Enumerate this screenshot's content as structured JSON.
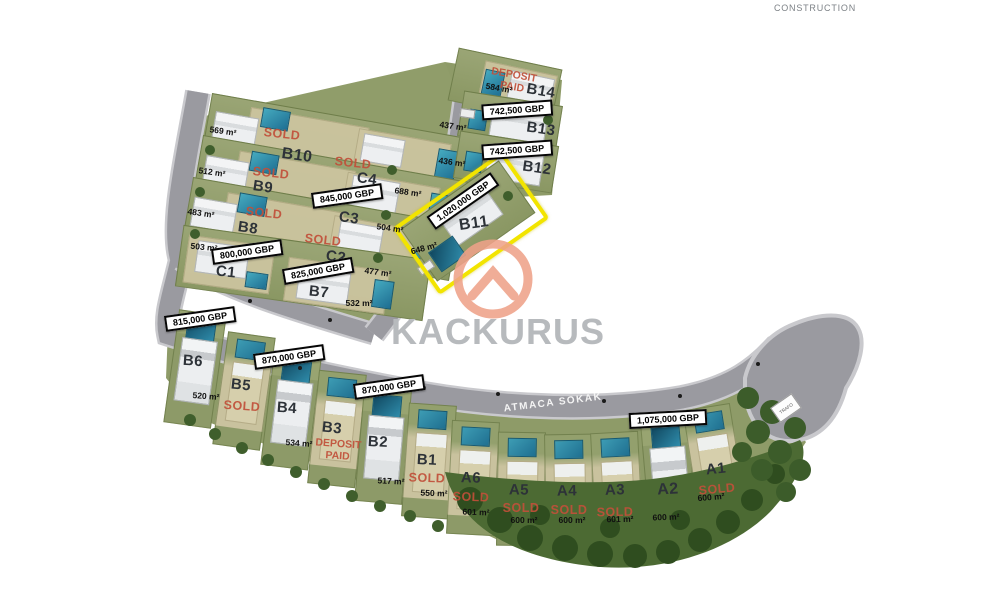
{
  "branding": {
    "watermark": "KACKURUS",
    "construction_label": "CONSTRUCTION"
  },
  "map": {
    "street_name": "ATMACA SOKAK",
    "trafo_label": "TRAFO",
    "highlighted_plot": "B11"
  },
  "colors": {
    "sold_text": "#c1503a",
    "highlight_border": "#f2e400",
    "logo": "#efa289",
    "watermark_text": "#b7babd",
    "road": "#9a9aa0",
    "grass": "#8e9b68"
  },
  "plots": [
    {
      "id": "B14",
      "status": "DEPOSIT PAID",
      "size": "584 m²"
    },
    {
      "id": "B13",
      "price": "742,500 GBP",
      "size": "437 m²"
    },
    {
      "id": "B12",
      "price": "742,500 GBP",
      "size": "436 m²"
    },
    {
      "id": "B11",
      "price": "1,020,000 GBP",
      "size": "648 m²",
      "highlighted": true
    },
    {
      "id": "B10",
      "status": "SOLD",
      "size": "569 m²"
    },
    {
      "id": "C4",
      "status": "SOLD",
      "size": "688 m²"
    },
    {
      "id": "B9",
      "status": "SOLD",
      "size": "512 m²"
    },
    {
      "id": "C3",
      "price": "845,000 GBP",
      "size": "504 m²"
    },
    {
      "id": "B8",
      "status": "SOLD",
      "size": "483 m²"
    },
    {
      "id": "C2",
      "status": "SOLD",
      "size": "477 m²"
    },
    {
      "id": "C1",
      "price": "800,000 GBP",
      "size": "503 m²"
    },
    {
      "id": "B7",
      "price": "825,000 GBP",
      "size": "532 m²"
    },
    {
      "id": "B6",
      "price": "815,000 GBP",
      "size": "520 m²"
    },
    {
      "id": "B5",
      "status": "SOLD"
    },
    {
      "id": "B4",
      "price": "870,000 GBP",
      "size": "534 m²"
    },
    {
      "id": "B3",
      "status": "DEPOSIT PAID"
    },
    {
      "id": "B2",
      "price": "870,000 GBP",
      "size": "517 m²"
    },
    {
      "id": "B1",
      "status": "SOLD",
      "size": "550 m²"
    },
    {
      "id": "A6",
      "status": "SOLD",
      "size": "601 m²"
    },
    {
      "id": "A5",
      "status": "SOLD",
      "size": "600 m²"
    },
    {
      "id": "A4",
      "status": "SOLD",
      "size": "600 m²"
    },
    {
      "id": "A3",
      "status": "SOLD",
      "size": "601 m²"
    },
    {
      "id": "A2",
      "price": "1,075,000 GBP",
      "size": "600 m²"
    },
    {
      "id": "A1",
      "status": "SOLD",
      "size": "600 m²"
    }
  ]
}
